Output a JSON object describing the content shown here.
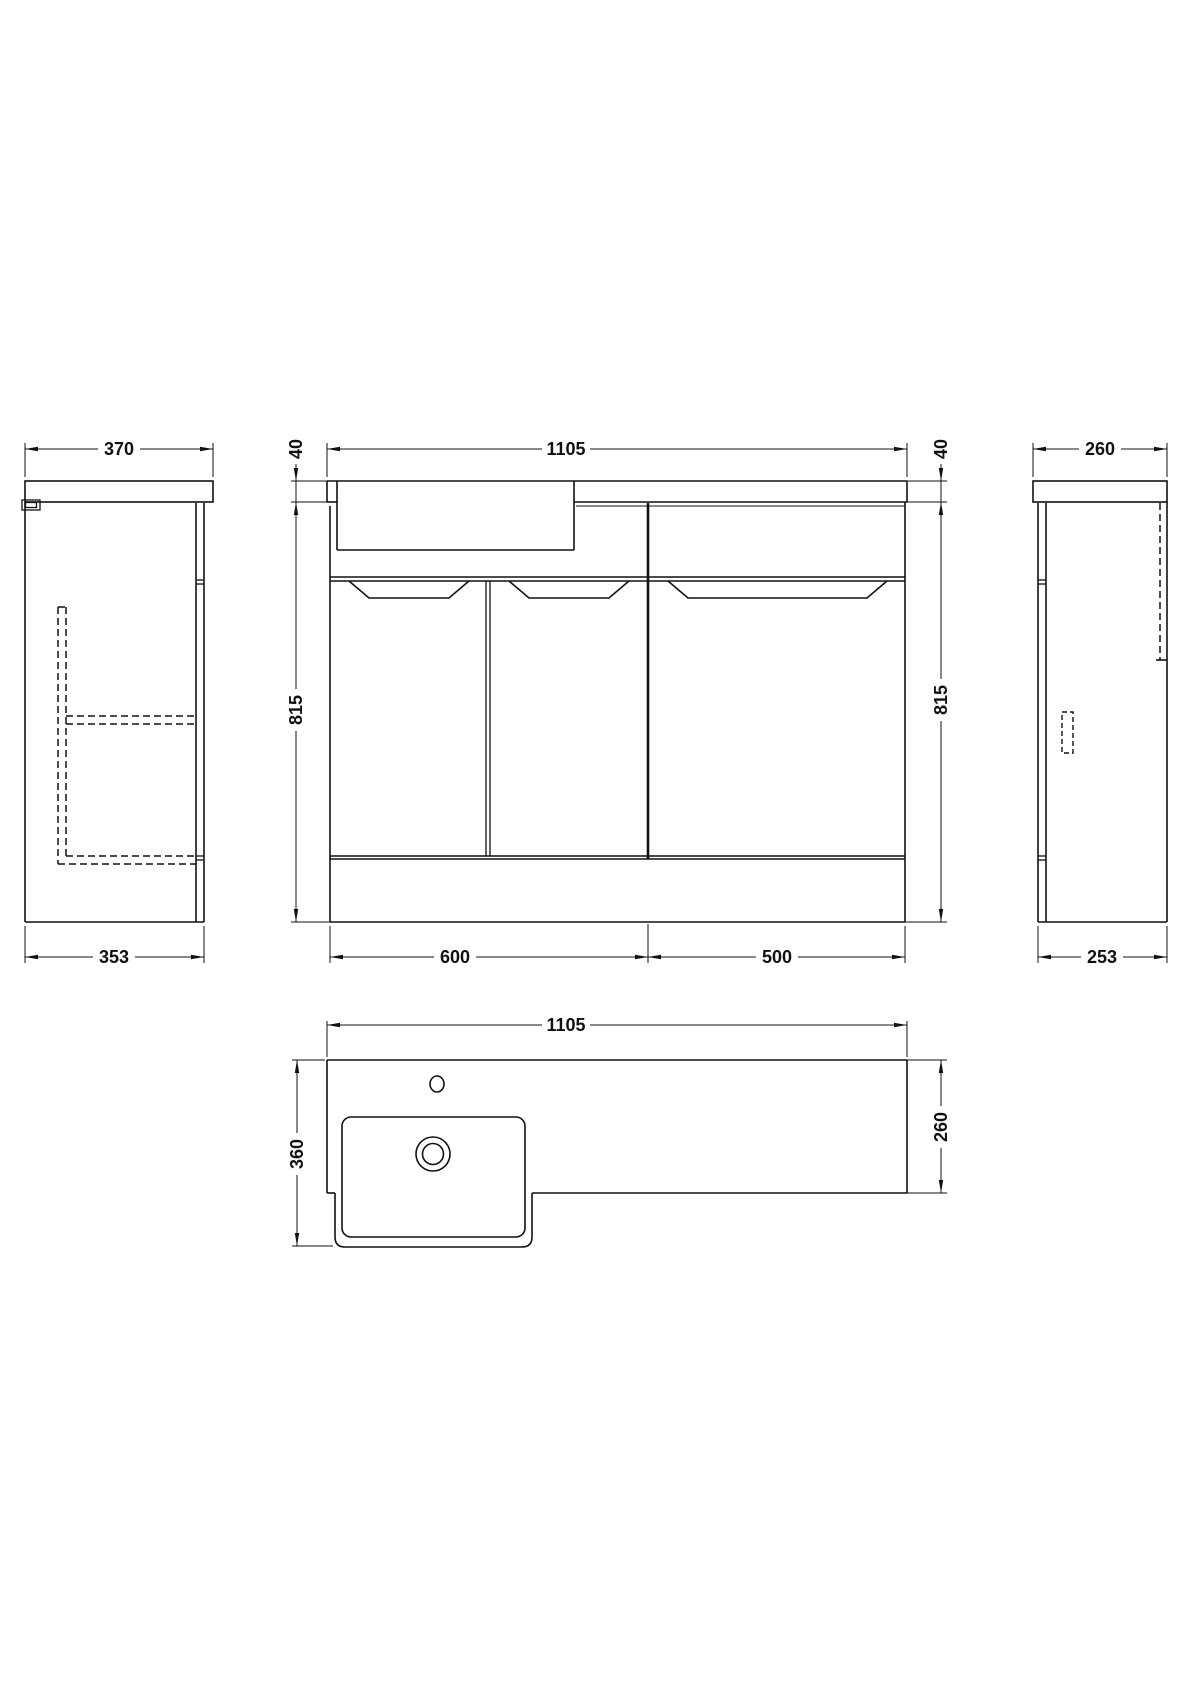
{
  "drawing": {
    "views": {
      "left_side": {
        "counter_width": "370",
        "cabinet_depth": "353"
      },
      "front": {
        "counter_width": "1105",
        "counter_thickness_left": "40",
        "counter_thickness_right": "40",
        "cabinet_height_left": "815",
        "cabinet_height_right": "815",
        "vanity_unit_width": "600",
        "wc_unit_width": "500"
      },
      "right_side": {
        "counter_width": "260",
        "cabinet_depth": "253"
      },
      "plan": {
        "counter_width": "1105",
        "counter_depth": "360",
        "wc_unit_depth": "260"
      }
    }
  }
}
